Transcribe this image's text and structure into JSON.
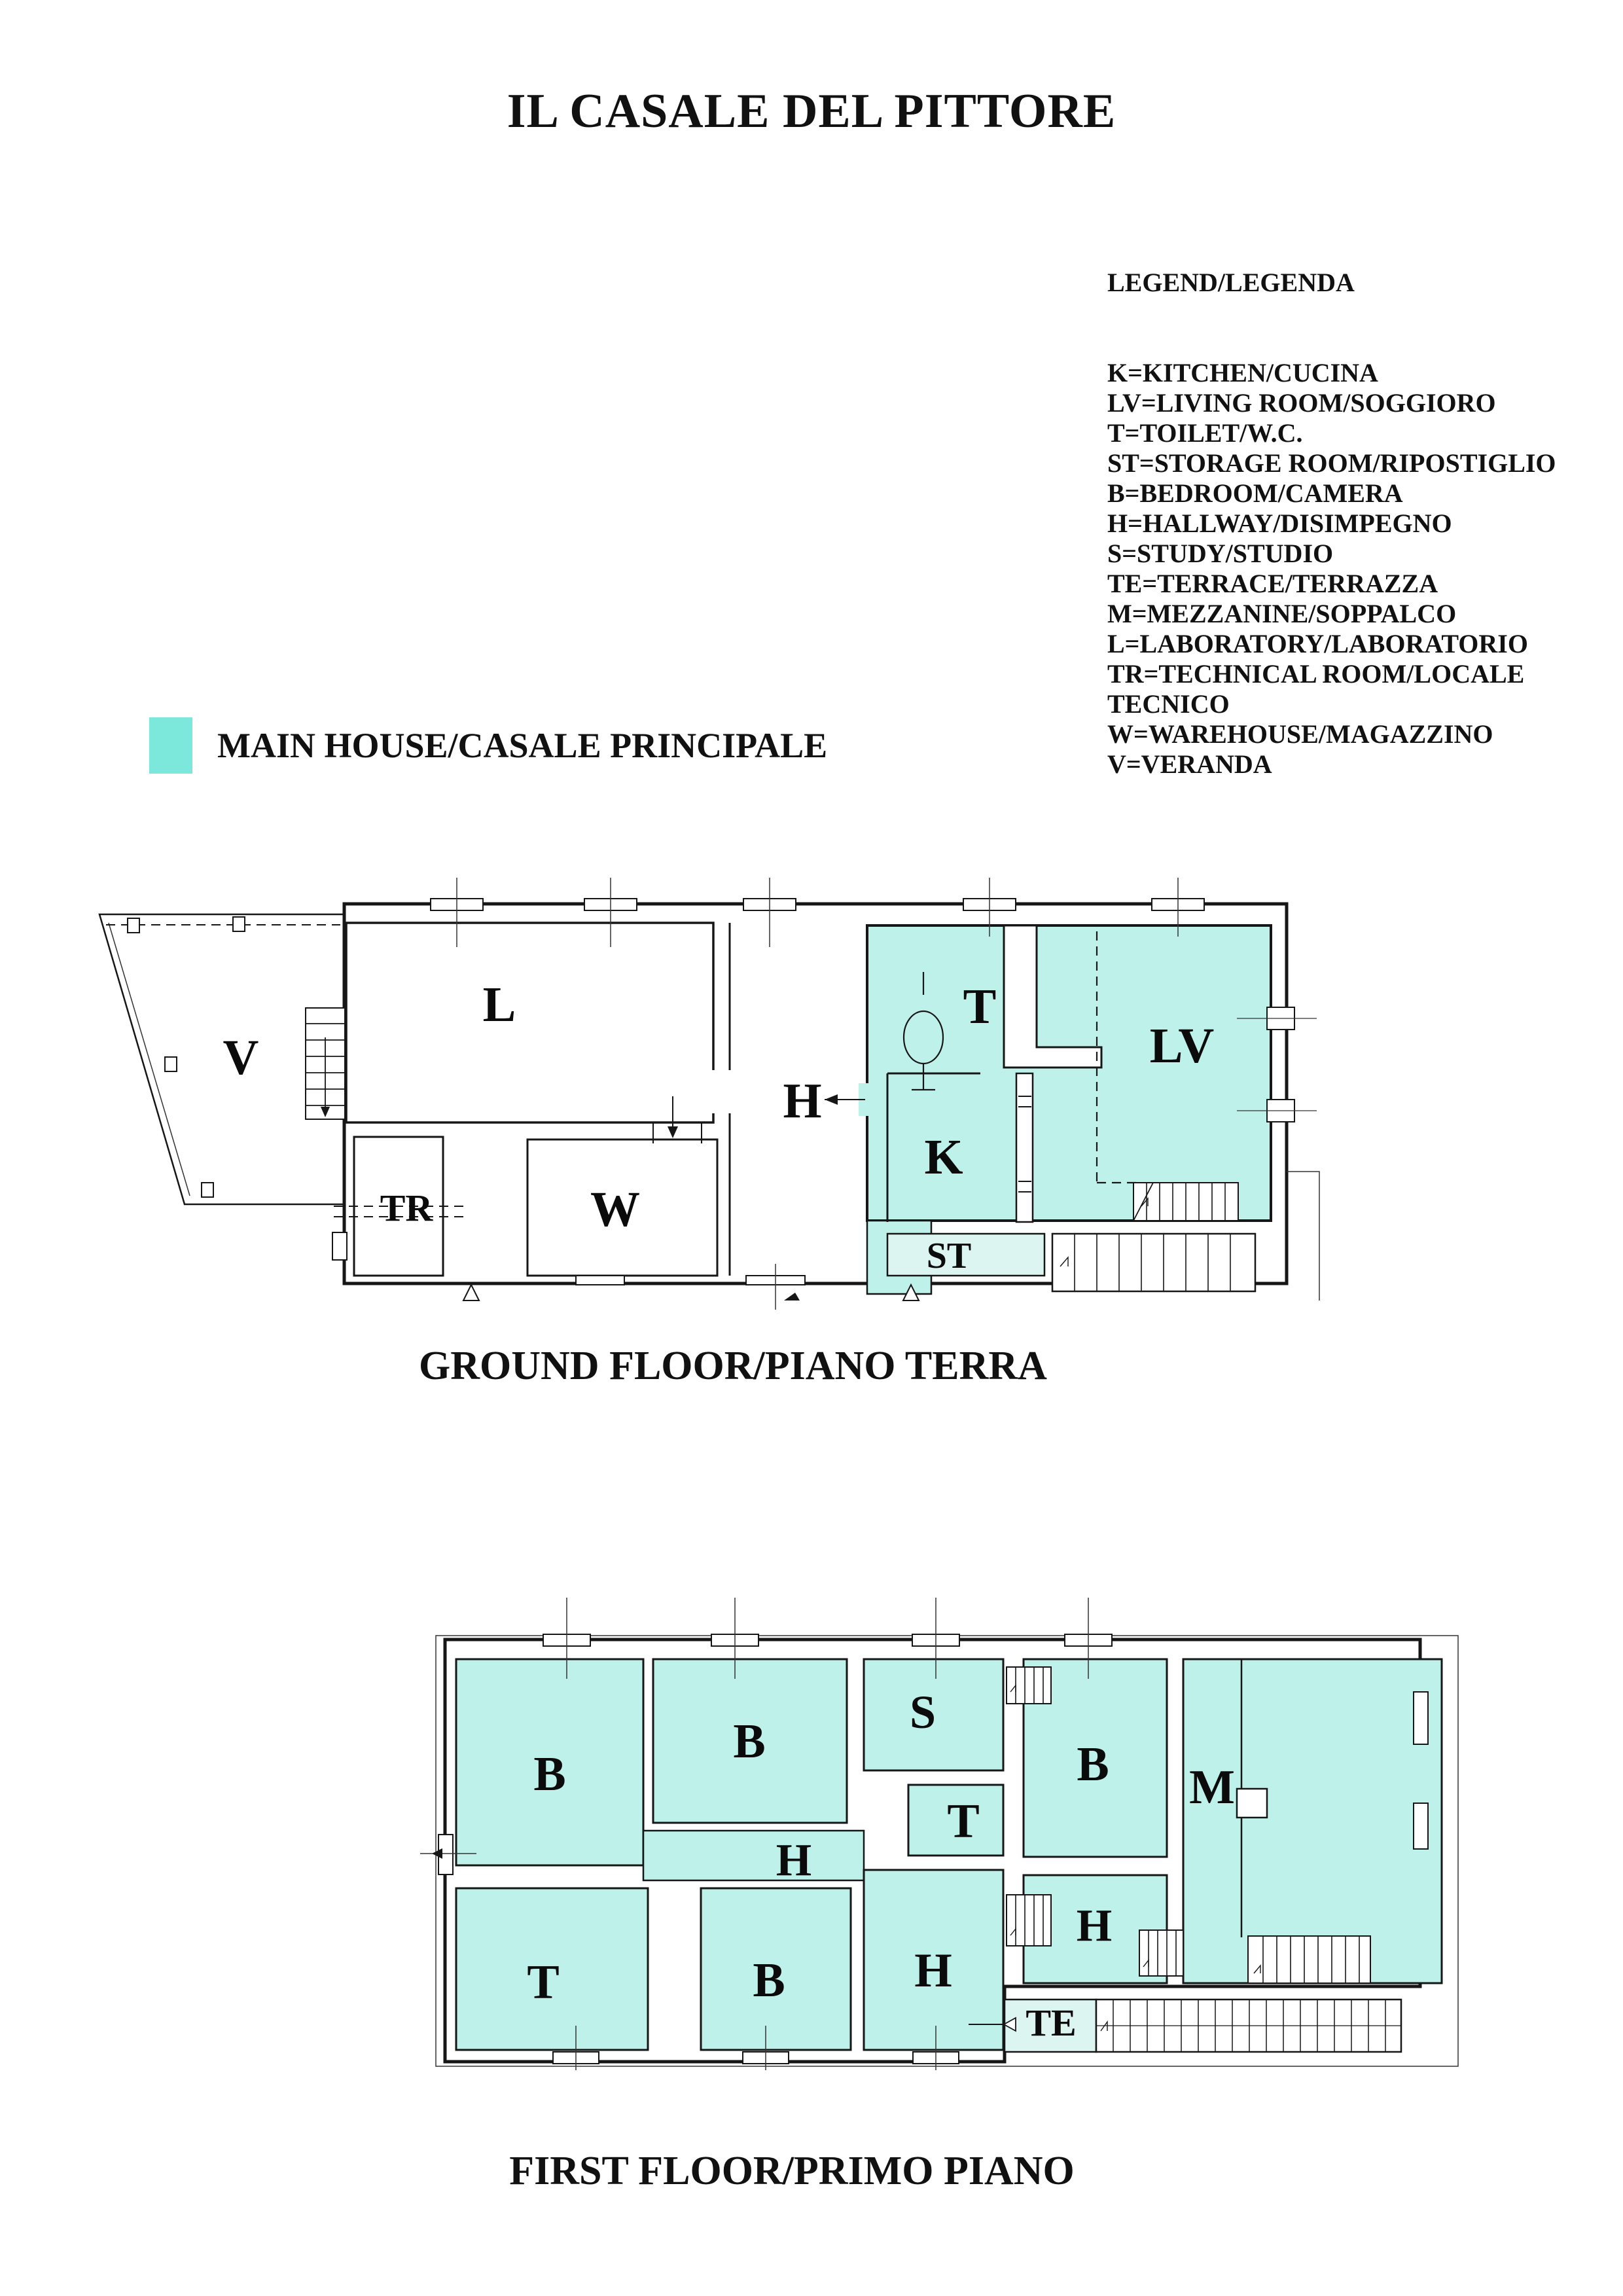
{
  "title": "IL CASALE DEL PITTORE",
  "colors": {
    "main_house": "#BFF1EB",
    "light_room": "#DCF5F1",
    "main_house_swatch": "#7CE8DB",
    "wall": "#161616"
  },
  "legend": {
    "heading": "LEGEND/LEGENDA",
    "lines": [
      "K=KITCHEN/CUCINA",
      "LV=LIVING ROOM/SOGGIORO",
      "T=TOILET/W.C.",
      "ST=STORAGE ROOM/RIPOSTIGLIO",
      "B=BEDROOM/CAMERA",
      "H=HALLWAY/DISIMPEGNO",
      "S=STUDY/STUDIO",
      "TE=TERRACE/TERRAZZA",
      "M=MEZZANINE/SOPPALCO",
      "L=LABORATORY/LABORATORIO",
      "TR=TECHNICAL ROOM/LOCALE",
      "TECNICO",
      "W=WAREHOUSE/MAGAZZINO",
      "V=VERANDA"
    ]
  },
  "key": {
    "label": "MAIN HOUSE/CASALE PRINCIPALE"
  },
  "ground_floor": {
    "caption": "GROUND FLOOR/PIANO TERRA",
    "rooms": {
      "v": "V",
      "l": "L",
      "h": "H",
      "t": "T",
      "k": "K",
      "lv": "LV",
      "tr": "TR",
      "w": "W",
      "st": "ST"
    }
  },
  "first_floor": {
    "caption": "FIRST FLOOR/PRIMO PIANO",
    "rooms": {
      "b1": "B",
      "b2": "B",
      "s": "S",
      "t1": "T",
      "b3": "B",
      "m": "M",
      "h1": "H",
      "t2": "T",
      "b4": "B",
      "h2": "H",
      "h3": "H",
      "te": "TE"
    }
  }
}
